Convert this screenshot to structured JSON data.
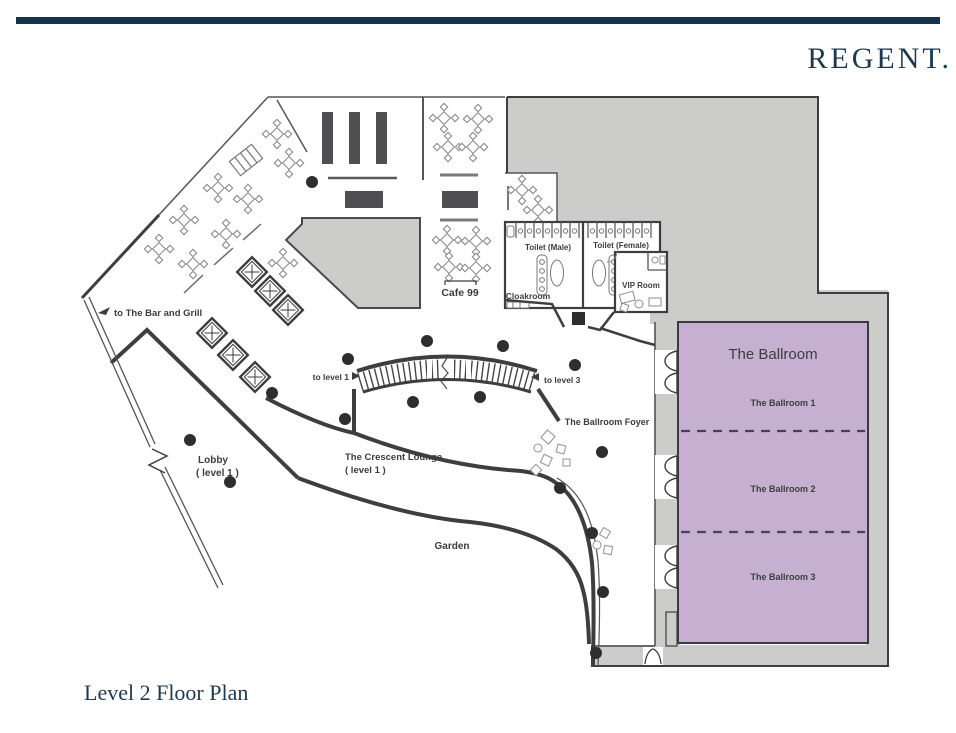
{
  "brand": {
    "logo": "REGENT."
  },
  "footer": {
    "title": "Level 2 Floor Plan"
  },
  "floor_plan": {
    "rooms": {
      "bar_grill": "to The Bar and Grill",
      "cafe": "Cafe 99",
      "toilet_male": "Toilet (Male)",
      "toilet_female": "Toilet (Female)",
      "cloakroom": "Cloakroom",
      "vip": "VIP Room",
      "ballroom": "The Ballroom",
      "ballroom1": "The Ballroom 1",
      "ballroom2": "The Ballroom 2",
      "ballroom3": "The Ballroom 3",
      "foyer": "The Ballroom Foyer",
      "to_level_1": "to level 1",
      "to_level_3": "to level 3",
      "crescent_lounge": "The Crescent Lounge",
      "crescent_level": "( level 1 )",
      "lobby": "Lobby",
      "lobby_level": "( level 1 )",
      "garden": "Garden"
    },
    "colors": {
      "ballroom_fill": "#c5b0d2",
      "service_gray": "#cccccb",
      "wall": "#3e3e40",
      "navy": "#16334a"
    }
  }
}
